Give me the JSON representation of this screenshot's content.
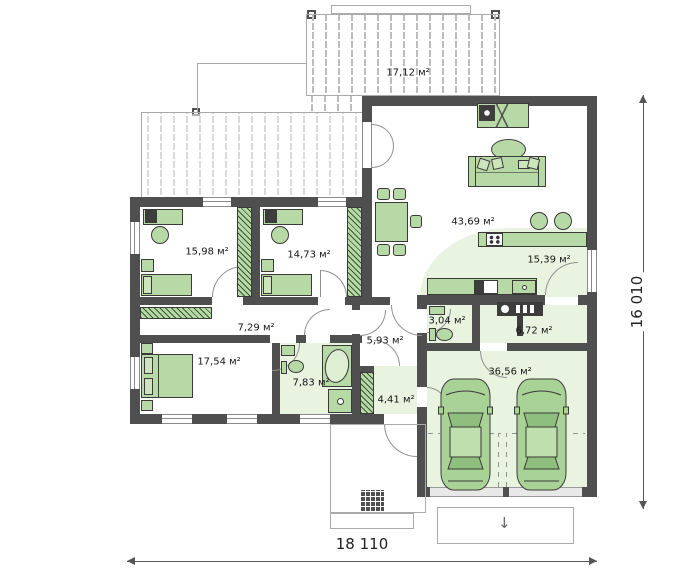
{
  "plan": {
    "terrace_label": "17,12 м²",
    "rooms": [
      {
        "id": "bedroom-1",
        "area": "15,98 м²"
      },
      {
        "id": "bedroom-2",
        "area": "14,73 м²"
      },
      {
        "id": "living-dining",
        "area": "43,69 м²"
      },
      {
        "id": "kitchen",
        "area": "15,39 м²"
      },
      {
        "id": "hallway",
        "area": "7,29 м²"
      },
      {
        "id": "wc",
        "area": "3,04 м²"
      },
      {
        "id": "utility",
        "area": "6,72 м²"
      },
      {
        "id": "bedroom-3",
        "area": "17,54 м²"
      },
      {
        "id": "corridor",
        "area": "5,93 м²"
      },
      {
        "id": "bathroom",
        "area": "7,83 м²"
      },
      {
        "id": "entry",
        "area": "4,41 м²"
      },
      {
        "id": "garage",
        "area": "36,56 м²"
      }
    ],
    "dimensions": {
      "width": "18 110",
      "height": "16 010"
    },
    "glyphs": {
      "driveway_arrow": "↓"
    },
    "colors": {
      "wall": "#4f4f4f",
      "furniture": "#b7d9a6",
      "floor_tint": "#e8f3e0",
      "outline": "#ababab"
    }
  }
}
